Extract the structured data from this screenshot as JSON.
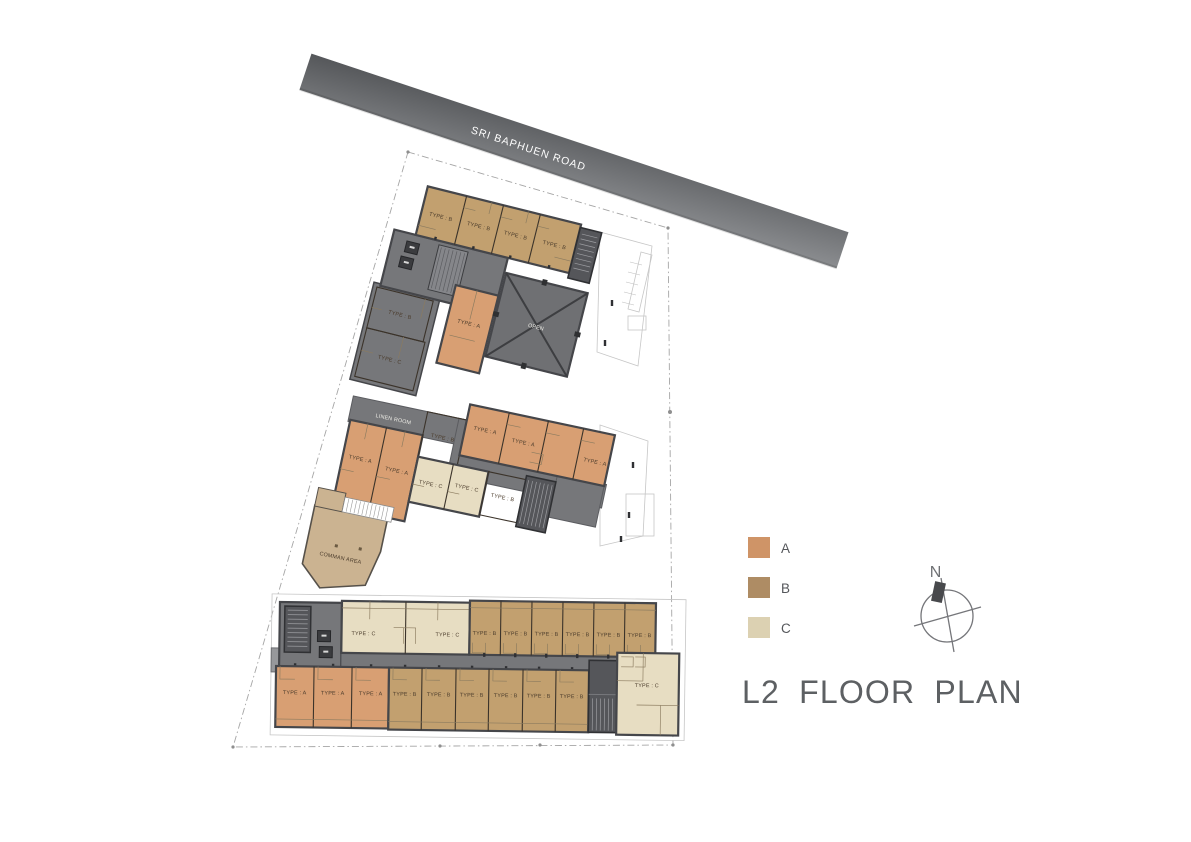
{
  "title": "L2 FLOOR PLAN",
  "road": {
    "label": "SRI BAPHUEN ROAD"
  },
  "compass": {
    "label": "N"
  },
  "legend": {
    "items": [
      {
        "label": "A",
        "color": "#cf9467"
      },
      {
        "label": "B",
        "color": "#ae8c64"
      },
      {
        "label": "C",
        "color": "#dcd1b2"
      }
    ]
  },
  "labels": {
    "type_a": "TYPE : A",
    "type_b": "TYPE : B",
    "type_c": "TYPE : C",
    "open": "OPEN",
    "linen_room": "LINEN ROOM",
    "common_area": "COMMAN AREA"
  },
  "colors": {
    "unit_a": "#d89f73",
    "unit_b": "#c2a06f",
    "unit_c": "#e7ddc2",
    "corridor": "#76777a",
    "core": "#55565a",
    "open_deck": "#6f7073",
    "wall": "#45464a",
    "common_area": "#cbb391",
    "road_start": "#55575a",
    "road_end": "#8b8d90",
    "title_text": "#5d6063"
  }
}
